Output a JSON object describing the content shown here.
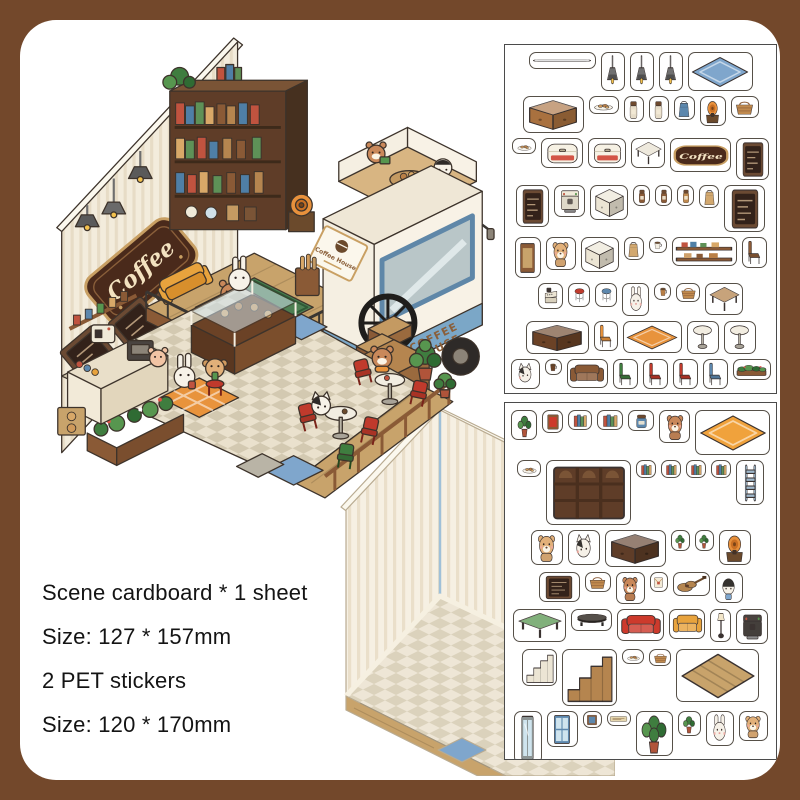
{
  "frame": {
    "border_color": "#73482b",
    "panel_color": "#ffffff"
  },
  "product_info": {
    "lines": [
      "Scene cardboard * 1 sheet",
      "Size: 127 * 157mm",
      "2 PET stickers",
      "Size: 120 * 170mm"
    ]
  },
  "scene": {
    "wall_sign_text": "Coffee",
    "truck_sign_title": "Coffee House",
    "truck_door_line1": "COFFEE",
    "truck_door_line2": "HOUSE",
    "palette": {
      "wall": "#f3ecdc",
      "wall_stripe": "#e7dcc6",
      "wood_dark": "#5f3d28",
      "wood_mid": "#a9713f",
      "wood_light": "#c8a36b",
      "floor_a": "#eae1cd",
      "floor_b": "#d3c9b1",
      "truck_white": "#f7f1e4",
      "truck_blue": "#7ba7c7",
      "sofa_red": "#cd3a2c",
      "sofa_yellow": "#e8a33d",
      "rug_green": "#4d7f52",
      "plant_green": "#3f7d3f",
      "sign_brown": "#4a2a1b",
      "sign_gold": "#c89f63",
      "mat_blue": "#7fa6cc"
    }
  },
  "sheets": [
    {
      "name": "pet-sticker-sheet-1",
      "stickers": [
        {
          "n": "metal-rod",
          "k": "rod",
          "w": 62,
          "h": 12
        },
        {
          "n": "pendant-lamp",
          "k": "lamp",
          "w": 19,
          "h": 34
        },
        {
          "n": "pendant-lamp",
          "k": "lamp",
          "w": 19,
          "h": 34
        },
        {
          "n": "pendant-lamp",
          "k": "lamp",
          "w": 19,
          "h": 34
        },
        {
          "n": "blue-checkered-rug",
          "k": "rug",
          "c": "#7fa6cc",
          "w": 60,
          "h": 34
        },
        {
          "n": "wood-counter",
          "k": "box",
          "c": "#a9713f",
          "w": 56,
          "h": 32
        },
        {
          "n": "donut-plate",
          "k": "plate",
          "w": 25,
          "h": 13
        },
        {
          "n": "bear-jar",
          "k": "jar",
          "c": "#e7ddc9",
          "w": 15,
          "h": 21
        },
        {
          "n": "bear-jar",
          "k": "jar",
          "c": "#e7ddc9",
          "w": 15,
          "h": 21
        },
        {
          "n": "blue-pouch",
          "k": "bag",
          "c": "#5c87ad",
          "w": 16,
          "h": 19
        },
        {
          "n": "coffee-grinder",
          "k": "gram",
          "w": 21,
          "h": 25
        },
        {
          "n": "bread-basket",
          "k": "basket",
          "w": 23,
          "h": 17
        },
        {
          "n": "cookie-plate",
          "k": "plate",
          "w": 19,
          "h": 11
        },
        {
          "n": "display-case",
          "k": "cooler",
          "w": 37,
          "h": 25
        },
        {
          "n": "bread-box",
          "k": "cooler",
          "w": 33,
          "h": 25
        },
        {
          "n": "side-table",
          "k": "tableS",
          "c": "#e9e2d2",
          "w": 29,
          "h": 25
        },
        {
          "n": "coffee-sign",
          "k": "plaque",
          "label": "Coffee",
          "w": 56,
          "h": 29
        },
        {
          "n": "menu-board",
          "k": "board",
          "w": 28,
          "h": 37
        },
        {
          "n": "menu-board",
          "k": "board",
          "w": 28,
          "h": 37
        },
        {
          "n": "coffee-machine",
          "k": "machine",
          "c": "#f0ead9",
          "w": 26,
          "h": 27
        },
        {
          "n": "drawer-cabinet",
          "k": "box",
          "c": "#ece5d4",
          "w": 33,
          "h": 30
        },
        {
          "n": "coffee-jar",
          "k": "jar",
          "c": "#8a5a36",
          "w": 12,
          "h": 16
        },
        {
          "n": "coffee-jar",
          "k": "jar",
          "c": "#8a5a36",
          "w": 12,
          "h": 16
        },
        {
          "n": "snack-jar",
          "k": "jar",
          "c": "#c08a4e",
          "w": 12,
          "h": 16
        },
        {
          "n": "paper-bag",
          "k": "bag",
          "w": 15,
          "h": 18
        },
        {
          "n": "big-menu-board",
          "k": "board",
          "w": 36,
          "h": 42
        },
        {
          "n": "cabinet-door",
          "k": "frame",
          "c": "#c8a36b",
          "w": 21,
          "h": 36
        },
        {
          "n": "bear-with-tray",
          "k": "bear",
          "c": "#e2b079",
          "w": 25,
          "h": 28
        },
        {
          "n": "drawer-cabinet",
          "k": "box",
          "c": "#ece5d4",
          "w": 33,
          "h": 30
        },
        {
          "n": "paper-bag",
          "k": "bag",
          "w": 15,
          "h": 18
        },
        {
          "n": "teacup",
          "k": "cup",
          "w": 13,
          "h": 11
        },
        {
          "n": "wall-shelf",
          "k": "shelfw",
          "w": 60,
          "h": 24
        },
        {
          "n": "cafe-chair",
          "k": "chair",
          "c": "#8a5a36",
          "w": 20,
          "h": 26
        },
        {
          "n": "register",
          "k": "register",
          "w": 20,
          "h": 21
        },
        {
          "n": "red-stool",
          "k": "stool",
          "c": "#c03a2c",
          "w": 17,
          "h": 19
        },
        {
          "n": "blue-stool",
          "k": "stool",
          "c": "#5c87ad",
          "w": 17,
          "h": 19
        },
        {
          "n": "bunny-with-cocoa",
          "k": "rabbit",
          "c": "#f6f1e8",
          "w": 22,
          "h": 28
        },
        {
          "n": "takeaway-cup",
          "k": "cup",
          "c": "#b97f46",
          "w": 12,
          "h": 12
        },
        {
          "n": "picnic-basket",
          "k": "basket",
          "w": 19,
          "h": 14
        },
        {
          "n": "square-table",
          "k": "tableS",
          "c": "#b5854f",
          "w": 33,
          "h": 27
        },
        {
          "n": "service-counter",
          "k": "box",
          "c": "#6b4226",
          "w": 58,
          "h": 28
        },
        {
          "n": "orange-chair",
          "k": "chair",
          "c": "#e8933c",
          "w": 19,
          "h": 25
        },
        {
          "n": "orange-plaid-rug",
          "k": "rug",
          "c": "#e8933c",
          "w": 54,
          "h": 27
        },
        {
          "n": "round-table",
          "k": "tableR",
          "w": 27,
          "h": 28
        },
        {
          "n": "round-table",
          "k": "tableR",
          "w": 27,
          "h": 28
        },
        {
          "n": "cat-with-beret",
          "k": "cat",
          "c": "#f6f1e8",
          "w": 24,
          "h": 25
        },
        {
          "n": "coffee-cup",
          "k": "cup",
          "c": "#6b4226",
          "w": 12,
          "h": 11
        },
        {
          "n": "bench-sofa",
          "k": "sofa",
          "c": "#8a5a36",
          "w": 36,
          "h": 24
        },
        {
          "n": "green-chair",
          "k": "chair",
          "c": "#3f7d3f",
          "w": 20,
          "h": 25
        },
        {
          "n": "red-chair",
          "k": "chair",
          "c": "#c03a2c",
          "w": 20,
          "h": 25
        },
        {
          "n": "red-chair",
          "k": "chair",
          "c": "#c03a2c",
          "w": 20,
          "h": 25
        },
        {
          "n": "blue-chair",
          "k": "chair",
          "c": "#5c87ad",
          "w": 20,
          "h": 25
        },
        {
          "n": "flower-planter",
          "k": "planter",
          "w": 33,
          "h": 16
        },
        {
          "n": "flower-planter",
          "k": "planter",
          "w": 33,
          "h": 16
        },
        {
          "n": "potted-plant",
          "k": "plant",
          "w": 16,
          "h": 19
        },
        {
          "n": "wood-fence",
          "k": "fence",
          "w": 74,
          "h": 21
        },
        {
          "n": "potted-plant",
          "k": "plant",
          "w": 17,
          "h": 20
        },
        {
          "n": "red-chair",
          "k": "chair",
          "c": "#c03a2c",
          "w": 18,
          "h": 23
        },
        {
          "n": "potted-tree",
          "k": "tree",
          "w": 30,
          "h": 36
        },
        {
          "n": "green-striped-rug",
          "k": "rugstripe",
          "c": "#57964f",
          "w": 34,
          "h": 19
        },
        {
          "n": "pet-bowl",
          "k": "bowl",
          "w": 13,
          "h": 9
        }
      ]
    },
    {
      "name": "pet-sticker-sheet-2",
      "stickers": [
        {
          "n": "hanging-plant",
          "k": "plant",
          "w": 21,
          "h": 25
        },
        {
          "n": "picture-frame",
          "k": "frame",
          "c": "#cd3a2c",
          "w": 16,
          "h": 18
        },
        {
          "n": "book-stack",
          "k": "books",
          "w": 19,
          "h": 15
        },
        {
          "n": "book-row",
          "k": "books",
          "w": 21,
          "h": 15
        },
        {
          "n": "storage-box",
          "k": "jar",
          "c": "#5c87ad",
          "w": 21,
          "h": 16
        },
        {
          "n": "bear-reading",
          "k": "bear",
          "c": "#c9885a",
          "w": 26,
          "h": 28
        },
        {
          "n": "orange-plaid-rug",
          "k": "rug",
          "c": "#f0a23c",
          "w": 70,
          "h": 40
        },
        {
          "n": "snack-plate",
          "k": "plate",
          "w": 19,
          "h": 12
        },
        {
          "n": "bookcase",
          "k": "bookcase",
          "w": 80,
          "h": 60
        },
        {
          "n": "mini-books",
          "k": "books",
          "w": 15,
          "h": 13
        },
        {
          "n": "mini-books",
          "k": "books",
          "w": 15,
          "h": 13
        },
        {
          "n": "mini-books",
          "k": "books",
          "w": 15,
          "h": 13
        },
        {
          "n": "mini-books",
          "k": "books",
          "w": 15,
          "h": 13
        },
        {
          "n": "ladder",
          "k": "ladder",
          "c": "#9fb8cc",
          "w": 23,
          "h": 40
        },
        {
          "n": "bear-plush",
          "k": "bear",
          "c": "#e2b079",
          "w": 27,
          "h": 30
        },
        {
          "n": "cat-with-cap",
          "k": "cat",
          "c": "#f6f1e8",
          "w": 27,
          "h": 30
        },
        {
          "n": "tv-sideboard",
          "k": "box",
          "c": "#5f3d28",
          "w": 56,
          "h": 32
        },
        {
          "n": "plant-pot",
          "k": "plant",
          "w": 14,
          "h": 16
        },
        {
          "n": "plant-pot",
          "k": "plant",
          "w": 14,
          "h": 16
        },
        {
          "n": "gramophone",
          "k": "gram",
          "w": 27,
          "h": 30
        },
        {
          "n": "cafe-sign-board",
          "k": "board",
          "w": 36,
          "h": 25
        },
        {
          "n": "snack-basket",
          "k": "basket",
          "w": 21,
          "h": 15
        },
        {
          "n": "bear-with-cup",
          "k": "bear",
          "c": "#c9885a",
          "w": 24,
          "h": 27
        },
        {
          "n": "letter",
          "k": "letter",
          "w": 13,
          "h": 15
        },
        {
          "n": "guitar",
          "k": "guitar",
          "w": 32,
          "h": 19
        },
        {
          "n": "penguin-with-drink",
          "k": "penguin",
          "w": 23,
          "h": 26
        },
        {
          "n": "green-table",
          "k": "tableS",
          "c": "#57964f",
          "w": 48,
          "h": 28
        },
        {
          "n": "coffee-table",
          "k": "tableO",
          "w": 36,
          "h": 17
        },
        {
          "n": "red-sofa",
          "k": "sofa",
          "c": "#cd3a2c",
          "w": 42,
          "h": 27
        },
        {
          "n": "yellow-armchair",
          "k": "sofa",
          "c": "#e8a33d",
          "w": 31,
          "h": 25
        },
        {
          "n": "floor-lamp",
          "k": "lamp2",
          "w": 16,
          "h": 28
        },
        {
          "n": "espresso-machine",
          "k": "machine",
          "c": "#4a4440",
          "w": 27,
          "h": 30
        },
        {
          "n": "step-stairs",
          "k": "stairs",
          "c": "#ece5d4",
          "w": 30,
          "h": 32
        },
        {
          "n": "staircase",
          "k": "stairs",
          "c": "#b5854f",
          "w": 50,
          "h": 52
        },
        {
          "n": "bread-tray",
          "k": "plate",
          "w": 17,
          "h": 10
        },
        {
          "n": "croissant-basket",
          "k": "basket",
          "w": 17,
          "h": 12
        },
        {
          "n": "wood-floor",
          "k": "floorwood",
          "w": 78,
          "h": 48
        },
        {
          "n": "glass-door",
          "k": "door",
          "w": 23,
          "h": 48
        },
        {
          "n": "blue-window",
          "k": "window",
          "w": 26,
          "h": 31
        },
        {
          "n": "small-frame",
          "k": "frame",
          "c": "#5c87ad",
          "w": 14,
          "h": 12
        },
        {
          "n": "shop-sign",
          "k": "sign2",
          "w": 19,
          "h": 10
        },
        {
          "n": "potted-tree",
          "k": "tree",
          "w": 32,
          "h": 40
        },
        {
          "n": "plant-red-pot",
          "k": "plant",
          "w": 18,
          "h": 20
        },
        {
          "n": "rabbit-with-ice-cream",
          "k": "rabbit",
          "c": "#f6f1e8",
          "w": 23,
          "h": 30
        },
        {
          "n": "koala-with-cookie",
          "k": "bear",
          "c": "#e2b079",
          "w": 24,
          "h": 25
        },
        {
          "n": "brown-drawers",
          "k": "box",
          "c": "#6b4226",
          "w": 36,
          "h": 26
        },
        {
          "n": "night-stand",
          "k": "box",
          "c": "#b5854f",
          "w": 29,
          "h": 26
        },
        {
          "n": "dark-cabinet",
          "k": "box",
          "c": "#5f3d28",
          "w": 36,
          "h": 27
        },
        {
          "n": "dark-cabinet",
          "k": "box",
          "c": "#5f3d28",
          "w": 36,
          "h": 27
        },
        {
          "n": "small-jar",
          "k": "jar",
          "c": "#cfa06a",
          "w": 11,
          "h": 13
        }
      ]
    }
  ]
}
